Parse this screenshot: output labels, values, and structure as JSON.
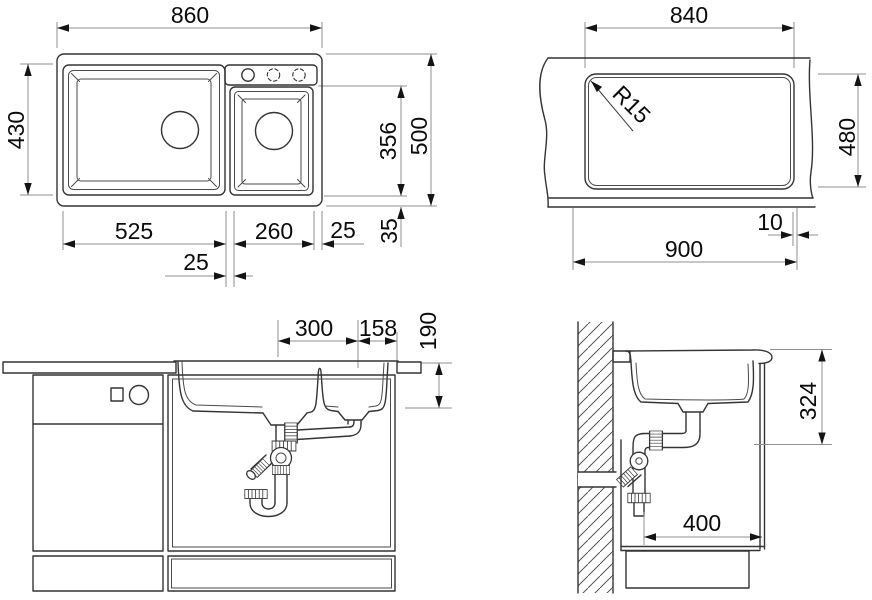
{
  "drawing": {
    "type": "sink-installation-technical-drawing",
    "line_color": "#343434",
    "dim_line_color": "#8f8f8f",
    "views": {
      "top": {
        "overall_width": "860",
        "bowl_width": "430",
        "main_bowl_length": "525",
        "divider": "25",
        "second_bowl_length": "260",
        "right_offset": "25",
        "bowl_to_edge": "356",
        "overall_depth": "500",
        "rim": "35"
      },
      "cutout": {
        "length": "840",
        "width": "480",
        "min_cabinet": "900",
        "offset": "10",
        "corner_radius": "R15"
      },
      "front": {
        "drain_spacing": "300",
        "drain_to_edge": "158",
        "bowl_depth": "190"
      },
      "side": {
        "outlet_height": "324",
        "min_depth": "400"
      }
    }
  }
}
